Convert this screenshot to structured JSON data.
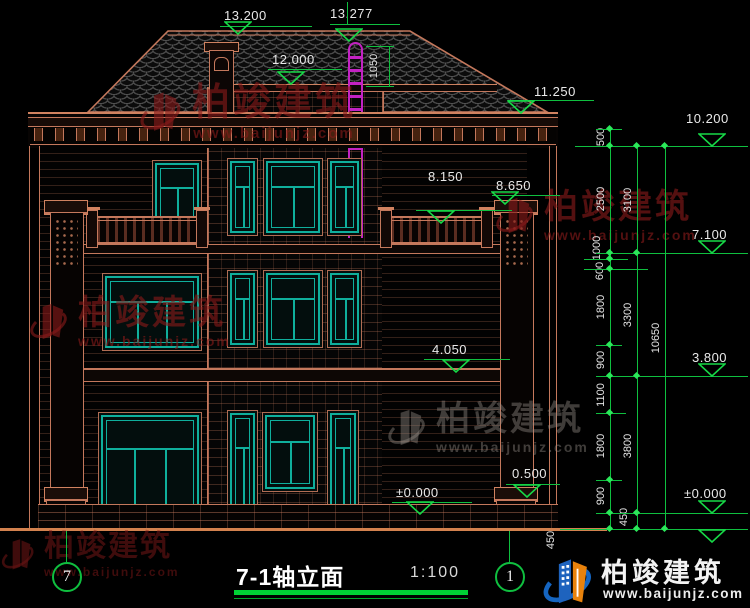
{
  "drawing": {
    "title": "7-1轴立面",
    "scale": "1:100",
    "axis_left": "7",
    "axis_right": "1"
  },
  "elevations": {
    "ridge": "13.200",
    "ladder_top": "13.277",
    "flat_roof": "12.000",
    "eave": "11.250",
    "right_top": "10.200",
    "pilaster_top": "8.650",
    "balcony": "8.150",
    "right_upper": "7.100",
    "floor2": "4.050",
    "right_lower": "3.800",
    "zero_building": "±0.000",
    "zero_right": "±0.000",
    "plinth_top": "0.500"
  },
  "dimensions": {
    "ladder": "1050",
    "chain_inner": [
      "500",
      "2500",
      "1000",
      "600",
      "1800",
      "900",
      "1100",
      "1800",
      "900",
      "450"
    ],
    "chain_middle": [
      "3100",
      "3300",
      "3800",
      "450"
    ],
    "chain_outer": [
      "10650"
    ]
  },
  "watermark": {
    "name": "柏竣建筑",
    "url": "www.baijunjz.com"
  },
  "logo": {
    "name": "柏竣建筑",
    "url": "www.baijunjz.com"
  },
  "colors": {
    "line": "#C4785C",
    "window": "#0FAF9C",
    "dimension": "#0FBF3F",
    "ladder": "#C322C3",
    "text": "#E9E9E9"
  }
}
